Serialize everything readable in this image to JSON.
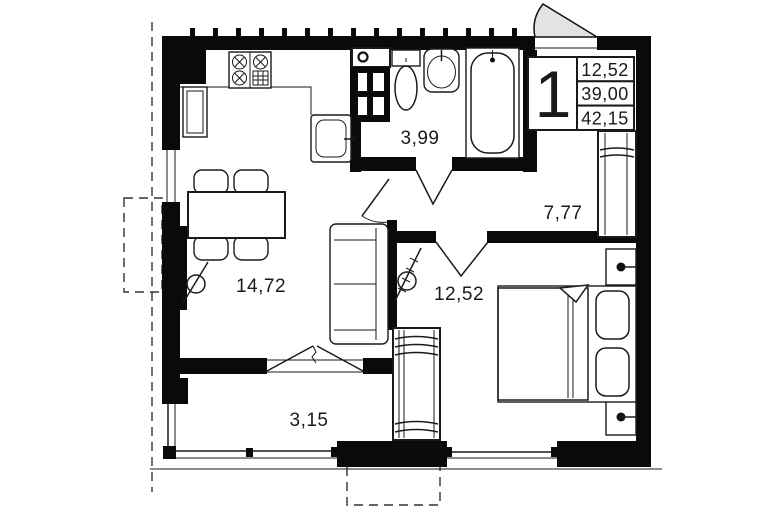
{
  "plan": {
    "title": "apartment-floor-plan",
    "info": {
      "unit": "1",
      "values": [
        "12,52",
        "39,00",
        "42,15"
      ]
    },
    "rooms": {
      "bathroom": {
        "name": "bathroom",
        "area": "3,99"
      },
      "hallway": {
        "name": "hallway",
        "area": "7,77"
      },
      "bedroom": {
        "name": "bedroom",
        "area": "12,52"
      },
      "living": {
        "name": "kitchen-living",
        "area": "14,72"
      },
      "balcony": {
        "name": "balcony",
        "area": "3,15"
      }
    },
    "fixtures": [
      "stove",
      "kitchen-sink",
      "fridge",
      "vent-shaft",
      "washer",
      "toilet",
      "washbasin",
      "bathtub",
      "dining-table",
      "chair",
      "sofa",
      "radiator",
      "double-bed",
      "pillow",
      "nightstand",
      "wardrobe",
      "entrance-door"
    ],
    "colors": {
      "wall": "#0a0a0a",
      "door_fill": "#e3e3e3",
      "line": "#1a1a1a",
      "background": "#ffffff"
    }
  }
}
